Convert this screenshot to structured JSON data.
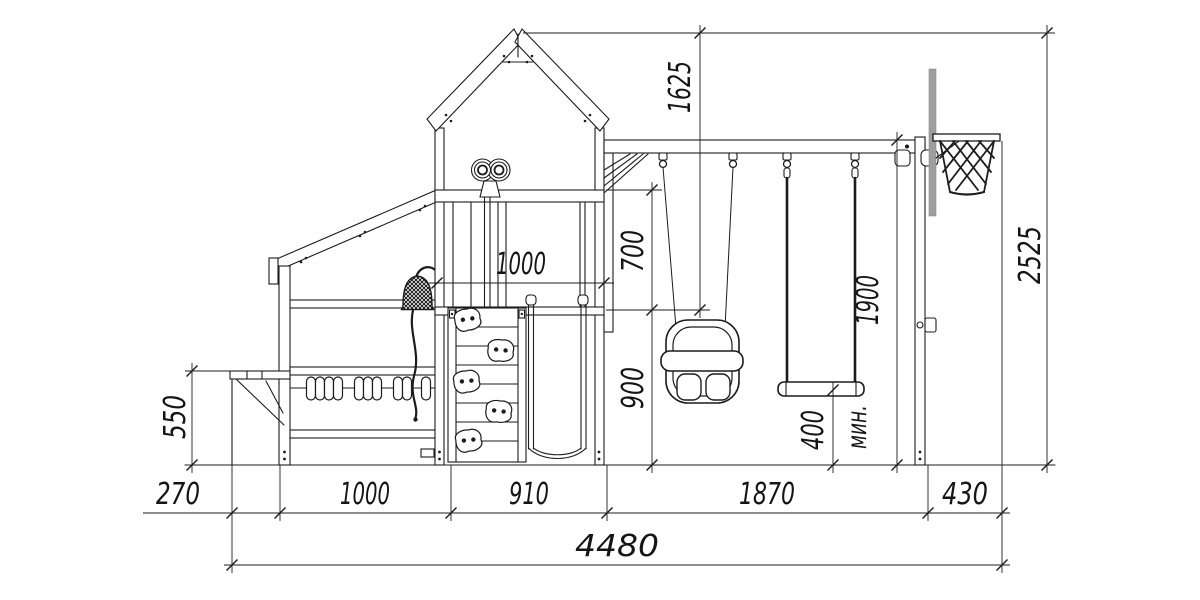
{
  "meta": {
    "title": "Playground side elevation drawing",
    "units": "mm"
  },
  "colors": {
    "line": "#1c1c1c",
    "background": "#ffffff",
    "basketball_pole_gray": "#9e9e9e"
  },
  "components": [
    "annex-with-table",
    "abacus",
    "bell",
    "tower-with-gable-roof",
    "binoculars",
    "climbing-wall",
    "slide",
    "swing-beam",
    "baby-swing",
    "flat-swing",
    "end-post",
    "basketball-hoop"
  ],
  "dimensions": {
    "peak_to_platform": "1625",
    "overall_height": "2525",
    "platform_width": "1000",
    "guardrail_height": "700",
    "platform_height": "900",
    "beam_height": "1900",
    "seat_clearance": "400",
    "seat_clearance_note": "мин.",
    "table_height": "550",
    "table_depth": "270",
    "annex_length": "1000",
    "tower_length": "910",
    "swing_bay_length": "1870",
    "hoop_overhang": "430",
    "overall_length": "4480"
  }
}
